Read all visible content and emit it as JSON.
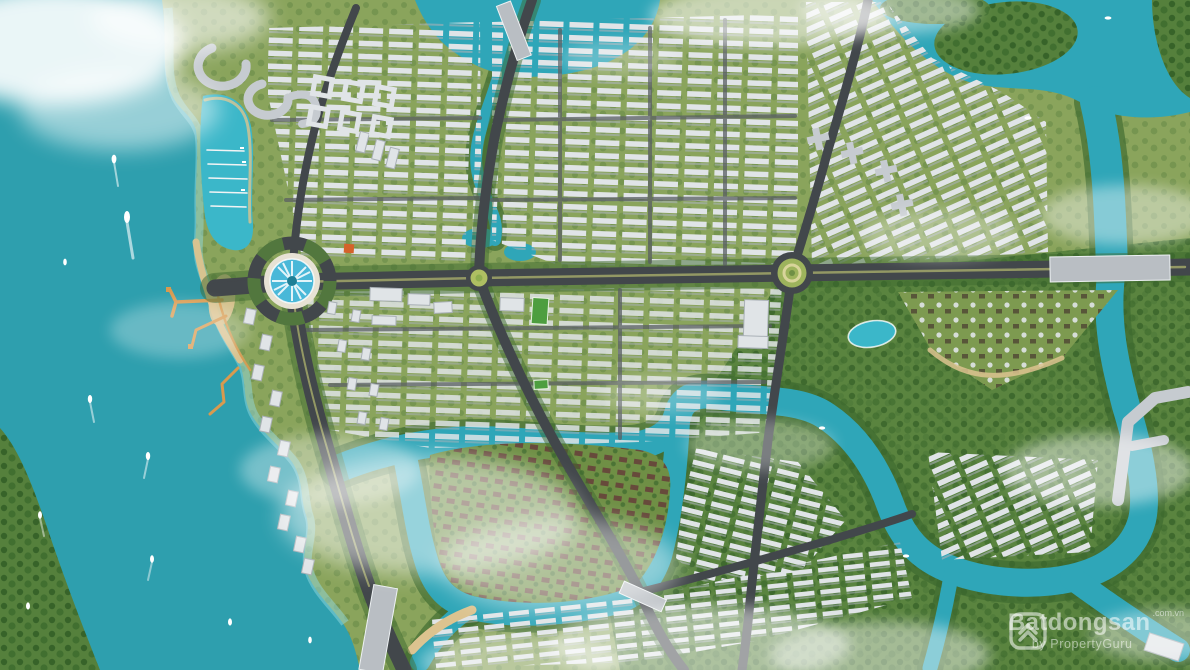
{
  "watermark": {
    "brand": "Batdongsan",
    "suffix": ".com.vn",
    "byline": "by PropertyGuru",
    "logo_icon": "batdongsan-house-logo"
  },
  "scene": {
    "type": "aerial-3d-masterplan-render",
    "description": "Bird's-eye render of a coastal township masterplan: turquoise sea with boats on the left, marina lagoon and beach piers, a grand boulevard with fountain roundabouts, dense townhouse districts, a villa district ringed by a winding river, forested riverlands to the south-east, and scattered clouds."
  },
  "palette": {
    "sea": "#2e9fae",
    "seashallow": "#8fd8dd",
    "lagoon": "#3bb7c9",
    "river": "#2fa6b8",
    "land": "#8aa45c",
    "landlight": "#9cb169",
    "forest": "#55803c",
    "tree": "#3c682e",
    "beach": "#dcc38f",
    "pier": "#d89a4f",
    "road": "#42474b",
    "roadlight": "#5a5f63",
    "median": "#a7ad6a",
    "bridgedeck": "#b9bec3",
    "roof": "#e0e4e7",
    "roofshade": "#a9b0b6",
    "bldggray": "#c6cbd0",
    "villaroof": "#66473a",
    "pitch": "#4d9e3f",
    "fountain": "#49b8d8",
    "orangeroof": "#d4622a",
    "cloud": "#ffffff",
    "boat": "#ffffff",
    "watermark": "rgba(255,255,255,0.55)"
  }
}
